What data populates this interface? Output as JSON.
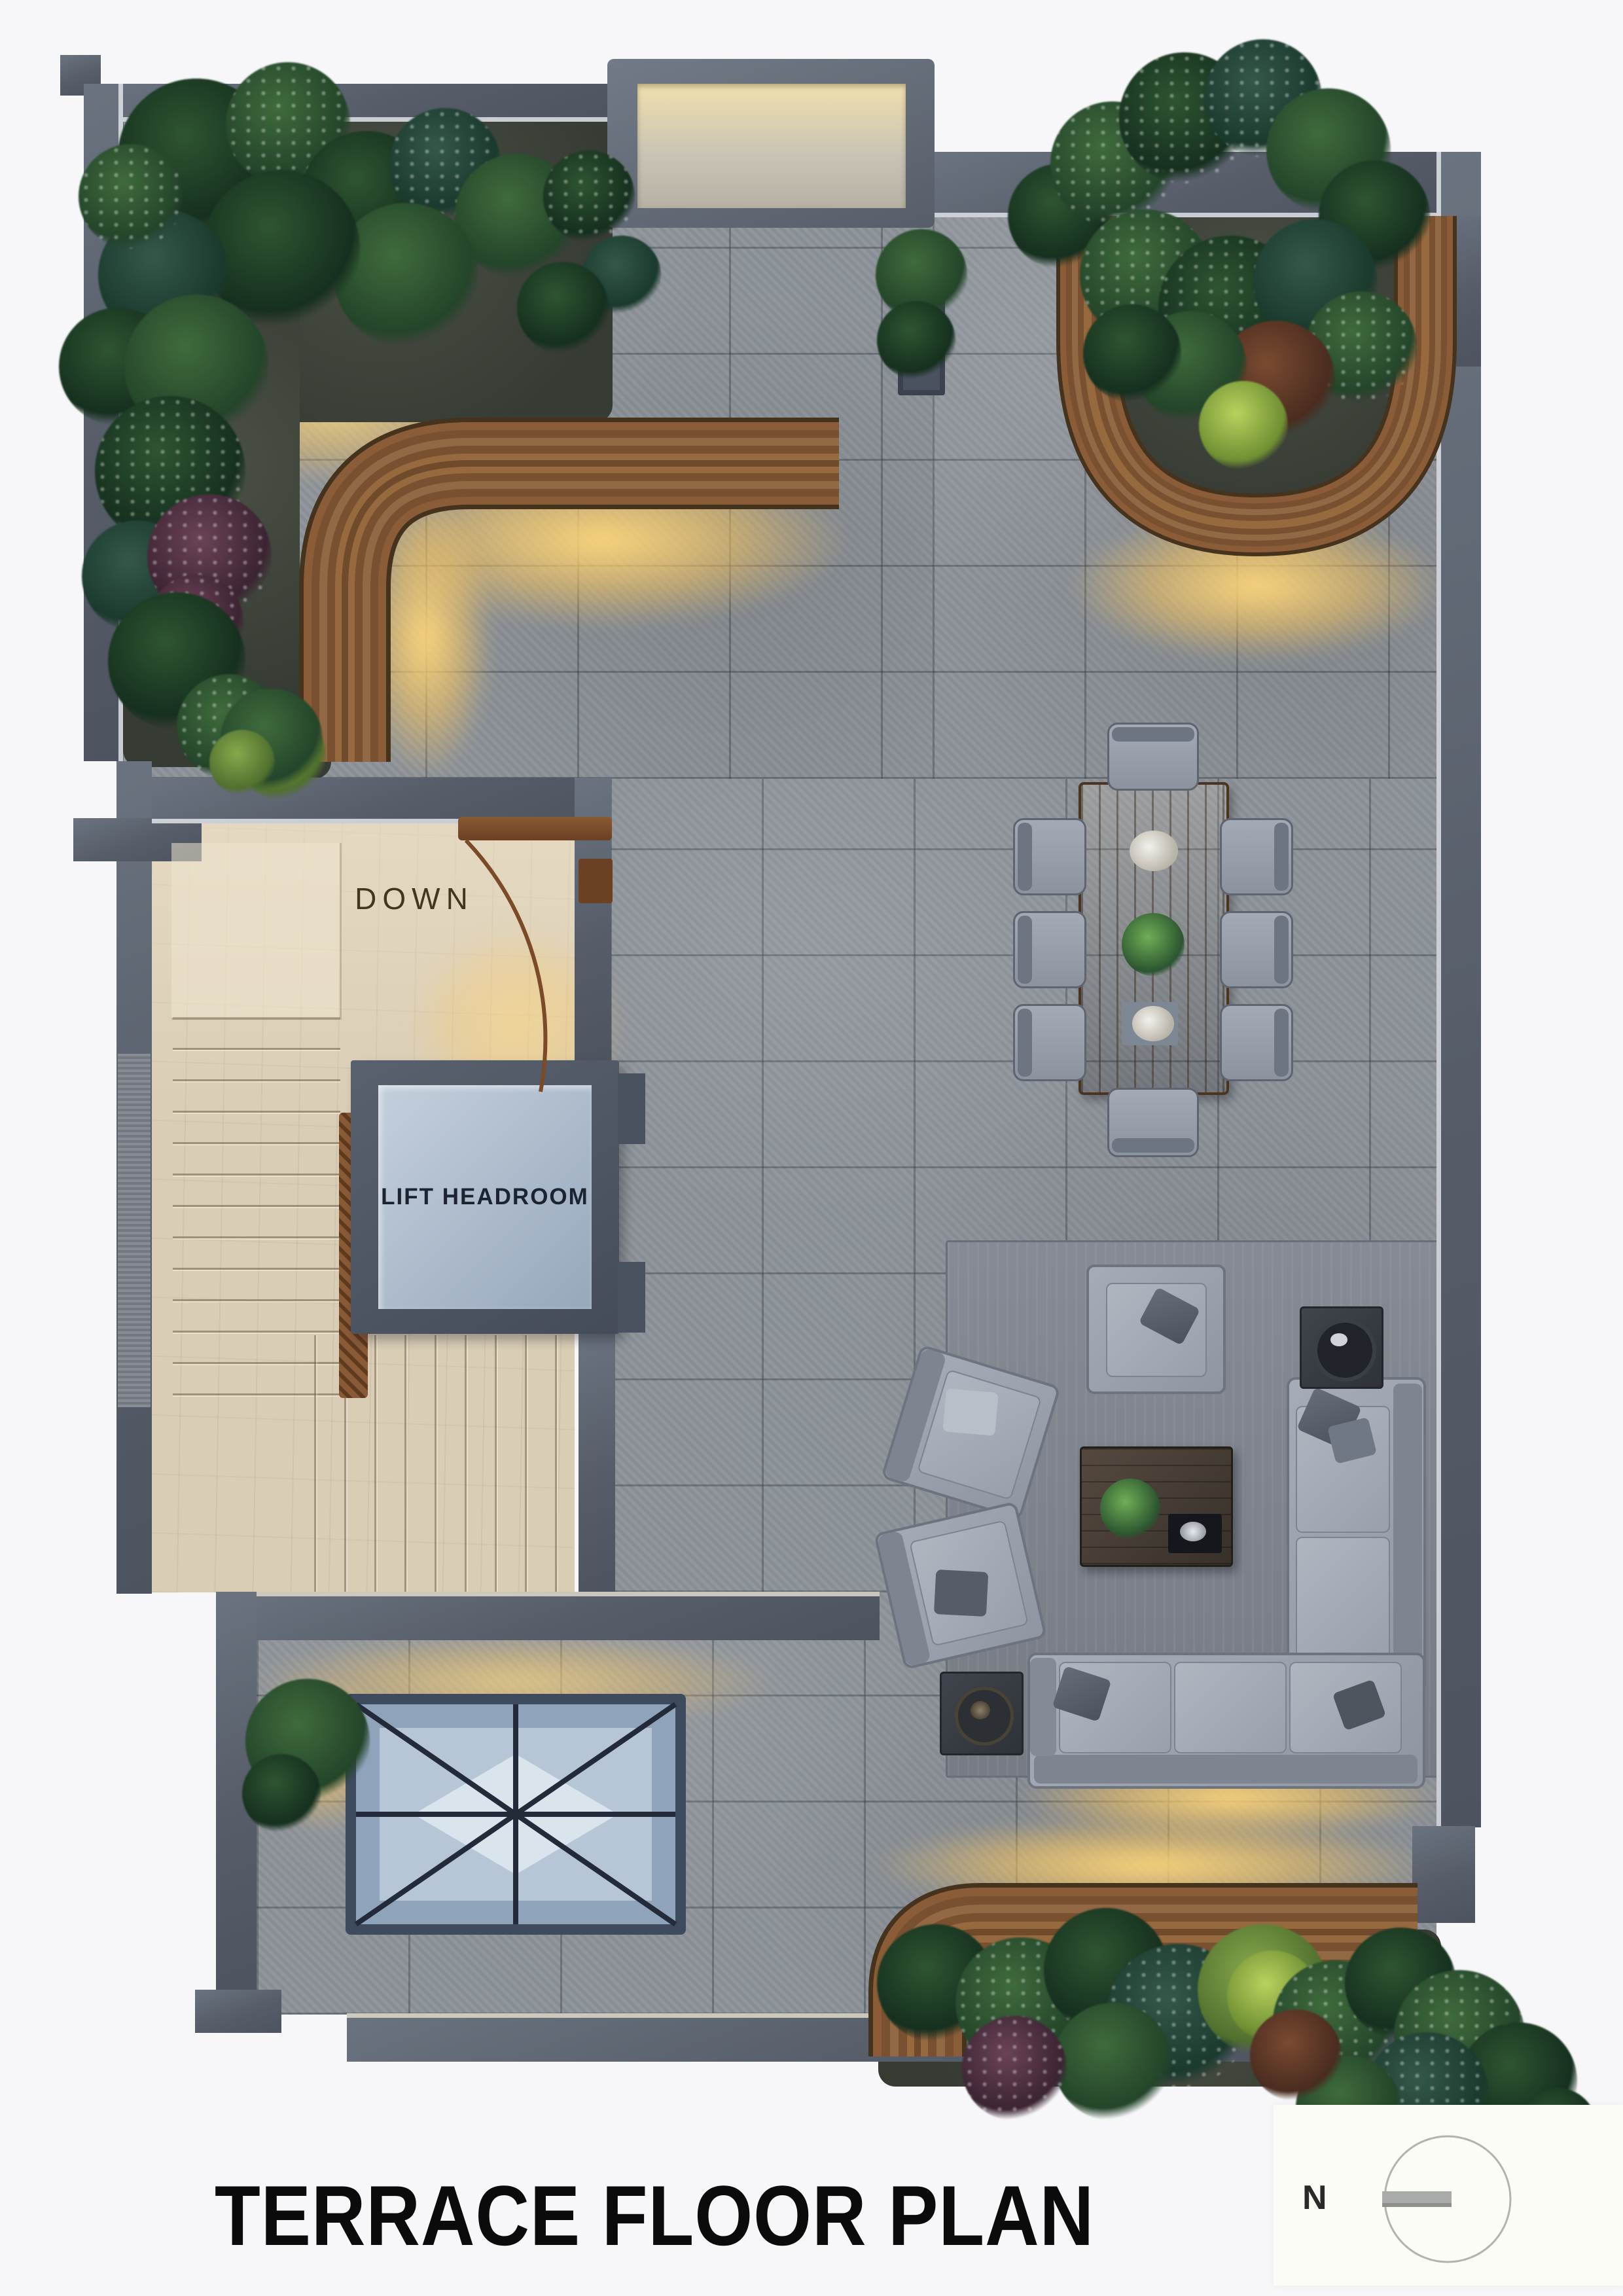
{
  "page": {
    "title": "TERRACE FLOOR PLAN"
  },
  "labels": {
    "stairs_direction": "DOWN",
    "lift": "LIFT HEADROOM",
    "compass_north": "N"
  },
  "colors": {
    "background": "#f7f7f9",
    "wall": "#565d69",
    "floor_tile": "#8d939a",
    "stair_floor": "#d9cdb6",
    "wood_bench": "#8a5d38",
    "glow": "#f5cf7f",
    "lift_panel": "#aebdcf",
    "sofa": "#9aa1ac",
    "skylight_glass": "#8fa3ba",
    "title_text": "#0b0b0b"
  }
}
